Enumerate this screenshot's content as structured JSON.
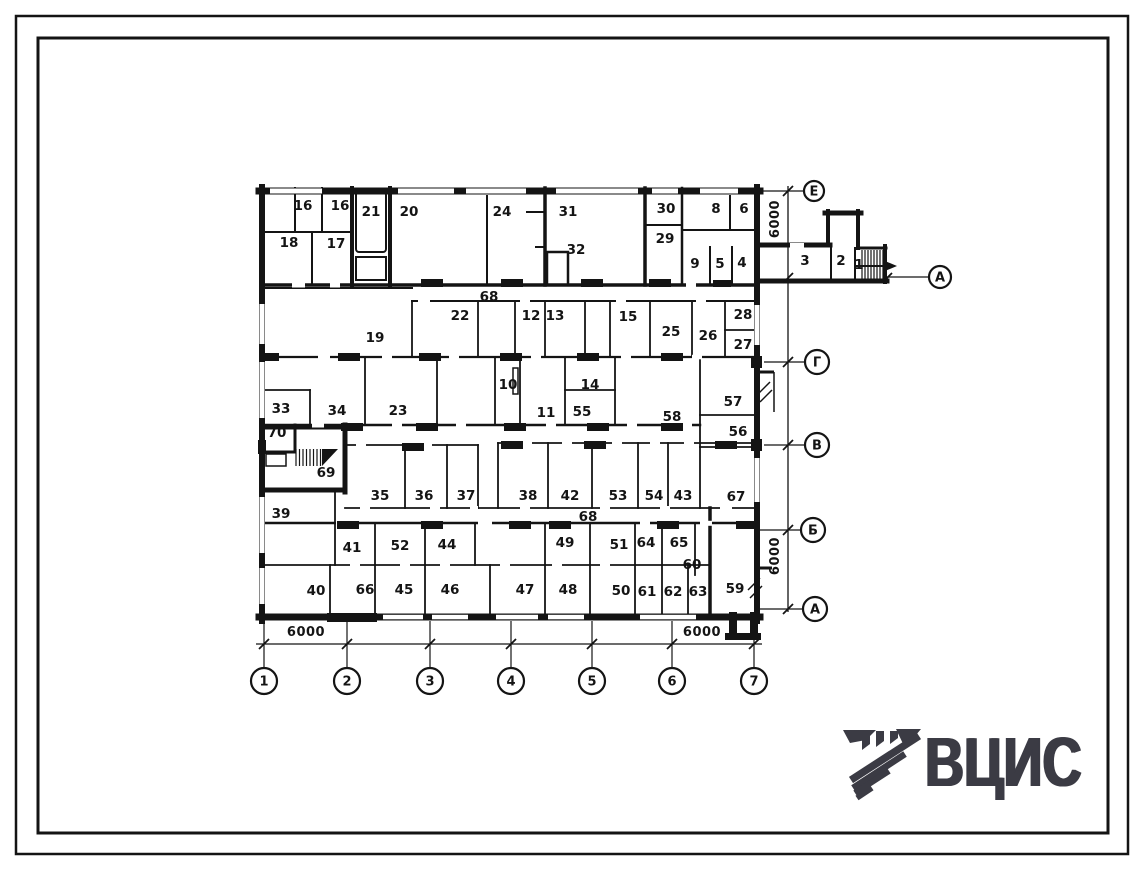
{
  "sheet": {
    "type_label": "floor-plan-drawing",
    "colors": {
      "ink": "#141414",
      "paper": "#ffffff",
      "logo": "#3b3b44"
    }
  },
  "drawing": {
    "room_labels": [
      {
        "t": "16",
        "x": 303,
        "y": 205
      },
      {
        "t": "16",
        "x": 340,
        "y": 205
      },
      {
        "t": "21",
        "x": 371,
        "y": 211
      },
      {
        "t": "20",
        "x": 409,
        "y": 211
      },
      {
        "t": "24",
        "x": 502,
        "y": 211
      },
      {
        "t": "31",
        "x": 568,
        "y": 211
      },
      {
        "t": "32",
        "x": 576,
        "y": 249
      },
      {
        "t": "30",
        "x": 666,
        "y": 208
      },
      {
        "t": "29",
        "x": 665,
        "y": 238
      },
      {
        "t": "8",
        "x": 716,
        "y": 208
      },
      {
        "t": "6",
        "x": 744,
        "y": 208
      },
      {
        "t": "9",
        "x": 695,
        "y": 263
      },
      {
        "t": "5",
        "x": 720,
        "y": 263
      },
      {
        "t": "4",
        "x": 742,
        "y": 262
      },
      {
        "t": "18",
        "x": 289,
        "y": 242
      },
      {
        "t": "17",
        "x": 336,
        "y": 243
      },
      {
        "t": "3",
        "x": 805,
        "y": 260
      },
      {
        "t": "2",
        "x": 841,
        "y": 260
      },
      {
        "t": "1",
        "x": 859,
        "y": 264
      },
      {
        "t": "68",
        "x": 489,
        "y": 296
      },
      {
        "t": "19",
        "x": 375,
        "y": 337
      },
      {
        "t": "22",
        "x": 460,
        "y": 315
      },
      {
        "t": "12",
        "x": 531,
        "y": 315
      },
      {
        "t": "13",
        "x": 555,
        "y": 315
      },
      {
        "t": "15",
        "x": 628,
        "y": 316
      },
      {
        "t": "25",
        "x": 671,
        "y": 331
      },
      {
        "t": "26",
        "x": 708,
        "y": 335
      },
      {
        "t": "28",
        "x": 743,
        "y": 314
      },
      {
        "t": "27",
        "x": 743,
        "y": 344
      },
      {
        "t": "10",
        "x": 508,
        "y": 384
      },
      {
        "t": "14",
        "x": 590,
        "y": 384
      },
      {
        "t": "11",
        "x": 546,
        "y": 412
      },
      {
        "t": "55",
        "x": 582,
        "y": 411
      },
      {
        "t": "58",
        "x": 672,
        "y": 416
      },
      {
        "t": "57",
        "x": 733,
        "y": 401
      },
      {
        "t": "56",
        "x": 738,
        "y": 431
      },
      {
        "t": "33",
        "x": 281,
        "y": 408
      },
      {
        "t": "34",
        "x": 337,
        "y": 410
      },
      {
        "t": "23",
        "x": 398,
        "y": 410
      },
      {
        "t": "70",
        "x": 277,
        "y": 432
      },
      {
        "t": "69",
        "x": 326,
        "y": 472
      },
      {
        "t": "35",
        "x": 380,
        "y": 495
      },
      {
        "t": "36",
        "x": 424,
        "y": 495
      },
      {
        "t": "37",
        "x": 466,
        "y": 495
      },
      {
        "t": "38",
        "x": 528,
        "y": 495
      },
      {
        "t": "42",
        "x": 570,
        "y": 495
      },
      {
        "t": "53",
        "x": 618,
        "y": 495
      },
      {
        "t": "54",
        "x": 654,
        "y": 495
      },
      {
        "t": "43",
        "x": 683,
        "y": 495
      },
      {
        "t": "67",
        "x": 736,
        "y": 496
      },
      {
        "t": "39",
        "x": 281,
        "y": 513
      },
      {
        "t": "68",
        "x": 588,
        "y": 516
      },
      {
        "t": "41",
        "x": 352,
        "y": 547
      },
      {
        "t": "52",
        "x": 400,
        "y": 545
      },
      {
        "t": "44",
        "x": 447,
        "y": 544
      },
      {
        "t": "49",
        "x": 565,
        "y": 542
      },
      {
        "t": "51",
        "x": 619,
        "y": 544
      },
      {
        "t": "64",
        "x": 646,
        "y": 542
      },
      {
        "t": "65",
        "x": 679,
        "y": 542
      },
      {
        "t": "60",
        "x": 692,
        "y": 564
      },
      {
        "t": "40",
        "x": 316,
        "y": 590
      },
      {
        "t": "66",
        "x": 365,
        "y": 589
      },
      {
        "t": "45",
        "x": 404,
        "y": 589
      },
      {
        "t": "46",
        "x": 450,
        "y": 589
      },
      {
        "t": "47",
        "x": 525,
        "y": 589
      },
      {
        "t": "48",
        "x": 568,
        "y": 589
      },
      {
        "t": "50",
        "x": 621,
        "y": 590
      },
      {
        "t": "61",
        "x": 647,
        "y": 591
      },
      {
        "t": "62",
        "x": 673,
        "y": 591
      },
      {
        "t": "63",
        "x": 698,
        "y": 591
      },
      {
        "t": "59",
        "x": 735,
        "y": 588
      }
    ],
    "axes_bottom": {
      "y": 681,
      "r": 13,
      "stem_top": 621,
      "stem_bottom": 667,
      "tick_y": 644,
      "items": [
        {
          "t": "1",
          "x": 264
        },
        {
          "t": "2",
          "x": 347
        },
        {
          "t": "3",
          "x": 430
        },
        {
          "t": "4",
          "x": 511
        },
        {
          "t": "5",
          "x": 592
        },
        {
          "t": "6",
          "x": 672
        },
        {
          "t": "7",
          "x": 754
        }
      ]
    },
    "axes_right": [
      {
        "t": "Е",
        "x": 814,
        "y": 191,
        "r": 10,
        "lx": 760
      },
      {
        "t": "Г",
        "x": 817,
        "y": 362,
        "r": 12,
        "lx": 764
      },
      {
        "t": "В",
        "x": 817,
        "y": 445,
        "r": 12,
        "lx": 764
      },
      {
        "t": "Б",
        "x": 813,
        "y": 530,
        "r": 12,
        "lx": 757
      },
      {
        "t": "А",
        "x": 815,
        "y": 609,
        "r": 12,
        "lx": 760
      }
    ],
    "axis_detached": {
      "t": "А",
      "x": 940,
      "y": 277,
      "r": 11,
      "lx": 887
    },
    "dim_labels": [
      {
        "t": "6000",
        "x": 306,
        "y": 636,
        "rot": 0
      },
      {
        "t": "6000",
        "x": 702,
        "y": 636,
        "rot": 0
      },
      {
        "t": "6000",
        "x": 779,
        "y": 219,
        "rot": -90
      },
      {
        "t": "6000",
        "x": 779,
        "y": 556,
        "rot": -90
      }
    ]
  },
  "logo": {
    "text": "ВЦИС",
    "color": "#3b3b44"
  }
}
